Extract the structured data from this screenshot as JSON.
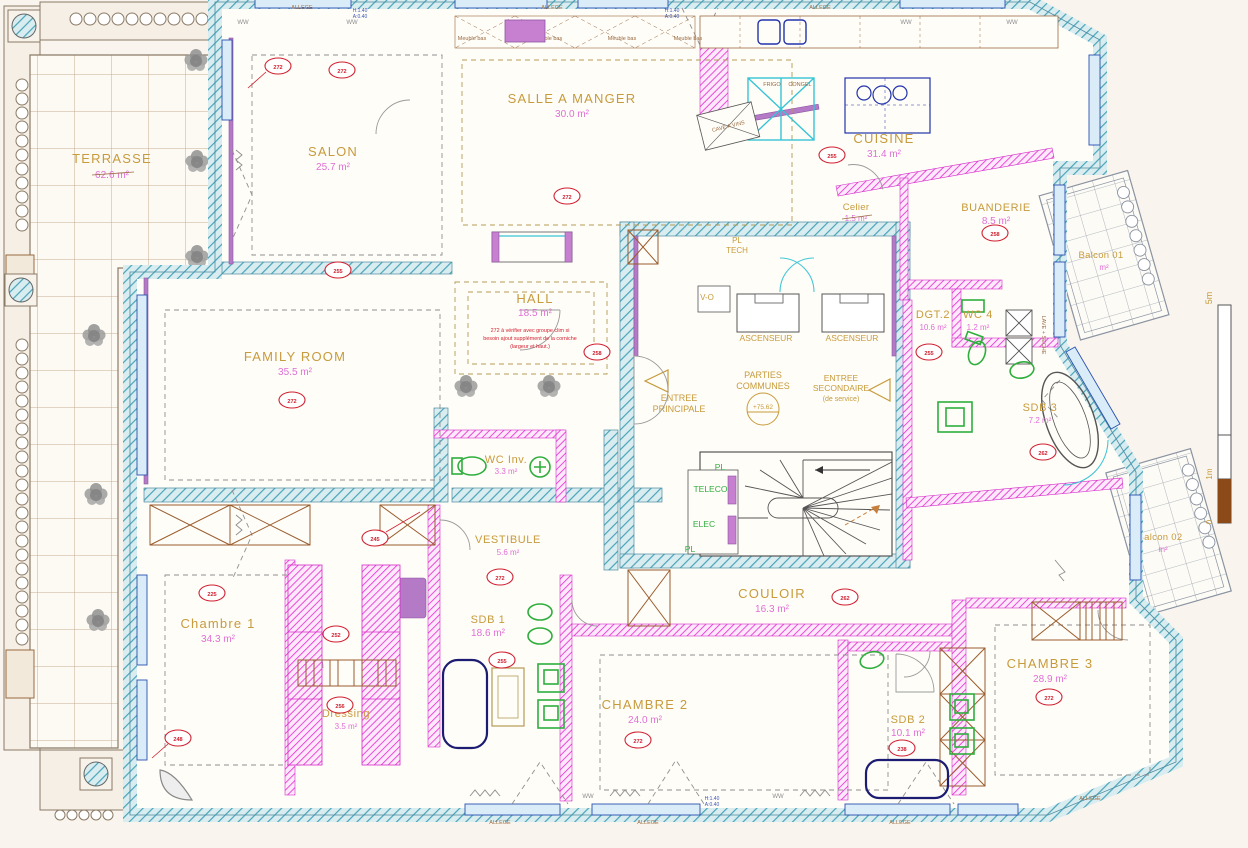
{
  "plan": {
    "rooms": [
      {
        "name": "TERRASSE",
        "area": "62.6 m²"
      },
      {
        "name": "SALON",
        "area": "25.7 m²"
      },
      {
        "name": "SALLE A MANGER",
        "area": "30.0 m²"
      },
      {
        "name": "CUISINE",
        "area": "31.4 m²"
      },
      {
        "name": "Celier",
        "area": "1.5 m²"
      },
      {
        "name": "BUANDERIE",
        "area": "8.5 m²"
      },
      {
        "name": "HALL",
        "area": "18.5 m²"
      },
      {
        "name": "FAMILY ROOM",
        "area": "35.5 m²"
      },
      {
        "name": "WC Inv.",
        "area": "3.3 m²"
      },
      {
        "name": "VESTIBULE",
        "area": "5.6 m²"
      },
      {
        "name": "DGT.2",
        "area": "10.6 m²"
      },
      {
        "name": "WC 4",
        "area": "1.2 m²"
      },
      {
        "name": "SDB 3",
        "area": "7.2 m²"
      },
      {
        "name": "COULOIR",
        "area": "16.3 m²"
      },
      {
        "name": "Chambre 1",
        "area": "34.3 m²"
      },
      {
        "name": "Dressing",
        "area": "3.5 m²"
      },
      {
        "name": "SDB 1",
        "area": "18.6 m²"
      },
      {
        "name": "CHAMBRE 2",
        "area": "24.0 m²"
      },
      {
        "name": "SDB 2",
        "area": "10.1 m²"
      },
      {
        "name": "CHAMBRE 3",
        "area": "28.9 m²"
      }
    ],
    "balcons": [
      {
        "name": "Balcon 01",
        "area": "m²"
      },
      {
        "name": "Balcon 02",
        "area": "m²"
      }
    ],
    "labels": {
      "ascenseur": "ASCENSEUR",
      "parties_1": "PARTIES",
      "parties_2": "COMMUNES",
      "level": "+75.62",
      "entree_p1": "ENTREE",
      "entree_p2": "PRINCIPALE",
      "entree_s1": "ENTREE",
      "entree_s2": "SECONDAIRE",
      "entree_s3": "(de service)",
      "vo": "V-O",
      "pl_tech1": "PL",
      "pl_tech2": "TECH",
      "telecom": "TELECOM",
      "elec": "ELEC",
      "pl": "PL",
      "frigo": "FRIGO",
      "congel": "CONGEL",
      "cave": "CAVE A VINS",
      "meuble_bas": "Meuble bas",
      "lave_seche": "LAVE + SECHE",
      "allege": "ALLEGE",
      "h140": "H:1.40",
      "a040": "A:0.40",
      "ww": "WW",
      "hall_note1": "272 à vérifier avec groupe clim si",
      "hall_note2": "besoin ajout supplément de la corniche",
      "hall_note3": "(largeur et haut.)"
    },
    "scale": {
      "five": "5m",
      "one": "1m",
      "zero": "0"
    },
    "refs": [
      "272",
      "272",
      "255",
      "272",
      "255",
      "272",
      "258",
      "258",
      "255",
      "262",
      "245",
      "272",
      "225",
      "248",
      "252",
      "256",
      "272",
      "262",
      "238",
      "272",
      "255"
    ]
  }
}
